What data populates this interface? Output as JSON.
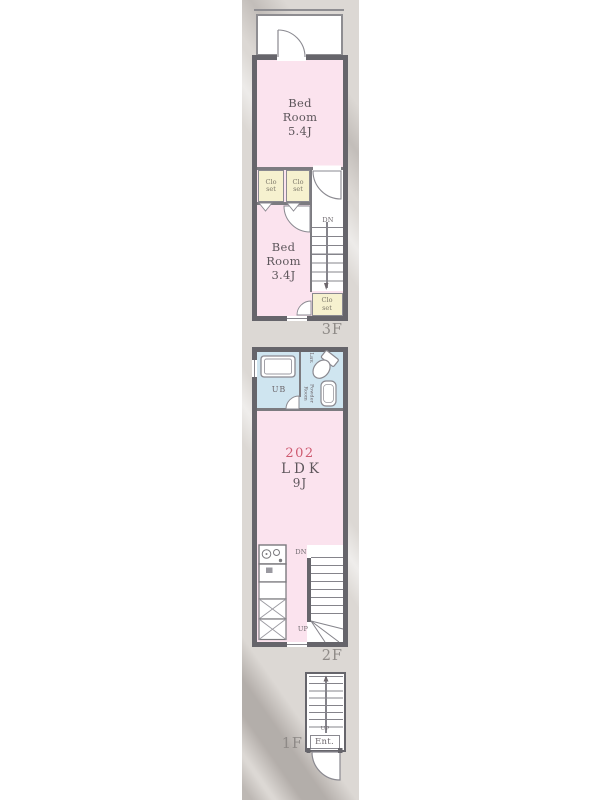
{
  "colors": {
    "room_pink": "#fbe3ee",
    "bath_blue": "#cfe5f0",
    "closet_yellow": "#f6f1cf",
    "wall_gray": "#66656b",
    "unit_number_red": "#ce5a70",
    "paper_beige": "#dcd8d4"
  },
  "floor3": {
    "label": "3F",
    "bedroom_a": "Bed\nRoom\n5.4J",
    "bedroom_b": "Bed\nRoom\n3.4J",
    "closet": "Clo\nset",
    "stairs_down": "DN"
  },
  "floor2": {
    "label": "2F",
    "unit_number": "202",
    "room_type": "LDK",
    "room_size": "9J",
    "unit_bath": "UB",
    "lavatory": "Lav.",
    "powder_room": "Powder\nRoom",
    "counter": "Coun\nter",
    "stairs_down": "DN",
    "stairs_up": "UP"
  },
  "floor1": {
    "label": "1F",
    "entrance": "Ent.",
    "stairs_up": "UP"
  }
}
